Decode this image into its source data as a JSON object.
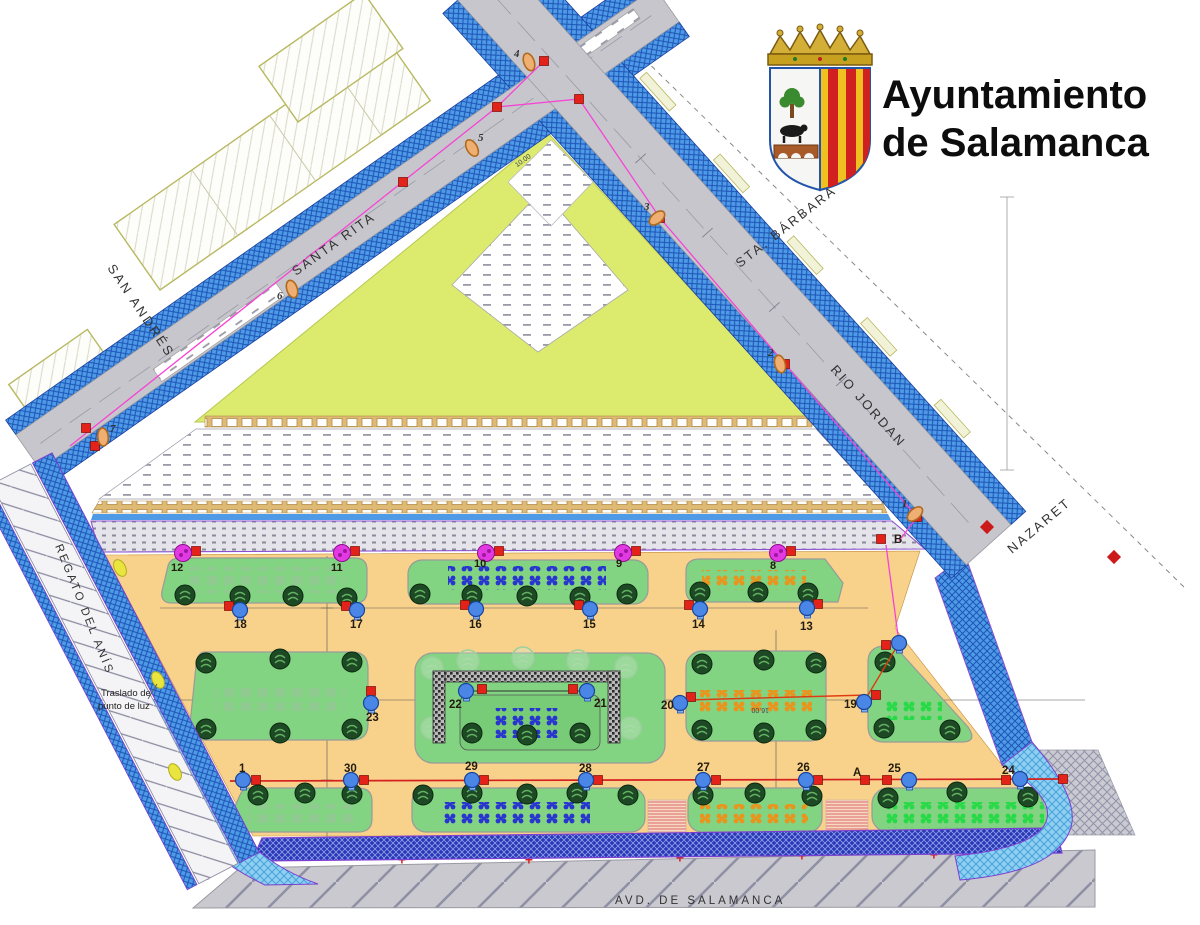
{
  "logo": {
    "title_line1": "Ayuntamiento",
    "title_line2": "de Salamanca"
  },
  "street_labels": {
    "san_andres": "SAN ANDRÉS",
    "santa_rita": "SANTA RITA",
    "sta_barbara": "STA. BÁRBARA",
    "rio_jordan": "RIO JORDAN",
    "nazaret": "NAZARET",
    "regato_del_anis": "REGATO DEL ANÍS",
    "avd_de_salamanca": "AVD.   DE   SALAMANCA"
  },
  "annotation": {
    "line1": "Traslado de",
    "line2": "punto de luz"
  },
  "reference_letters": {
    "a": "A",
    "b": "B"
  },
  "dimensions": {
    "road_width": "10.00",
    "bed_length": "16.00"
  },
  "relocated_light_markers": [
    "12",
    "11",
    "10",
    "9",
    "8"
  ],
  "new_light_markers_row1": [
    "18",
    "17",
    "16",
    "15",
    "14",
    "13"
  ],
  "new_light_markers_row2": [
    "23",
    "22",
    "21",
    "20",
    "19"
  ],
  "new_light_markers_row3": [
    "1",
    "30",
    "29",
    "28",
    "27",
    "26",
    "25",
    "24"
  ],
  "existing_lamp_markers": [
    "1",
    "2",
    "3",
    "4",
    "5",
    "6",
    "7"
  ],
  "icons": {
    "existing_tree": "dark-green-circle",
    "proposed_tree": "light-green-outline-circle",
    "new_light_point": "blue-circle",
    "relocated_light_point": "magenta-circle",
    "existing_lamp": "orange-ellipse",
    "junction_box": "red-square",
    "boundary_mark": "red-diamond"
  },
  "colors": {
    "lawn": "#dcea6e",
    "plaza": "#f8d28a",
    "garden_bed": "#82d382",
    "sidewalk_blue": "#4f9ae6",
    "road_gray": "#c6c6cc",
    "cable_pink": "#f743d4",
    "cable_red": "#d42020",
    "plants_blue": "#2836cf",
    "plants_orange": "#e8951e",
    "plants_light_green": "#92c892",
    "plants_bright_green": "#28d948"
  }
}
